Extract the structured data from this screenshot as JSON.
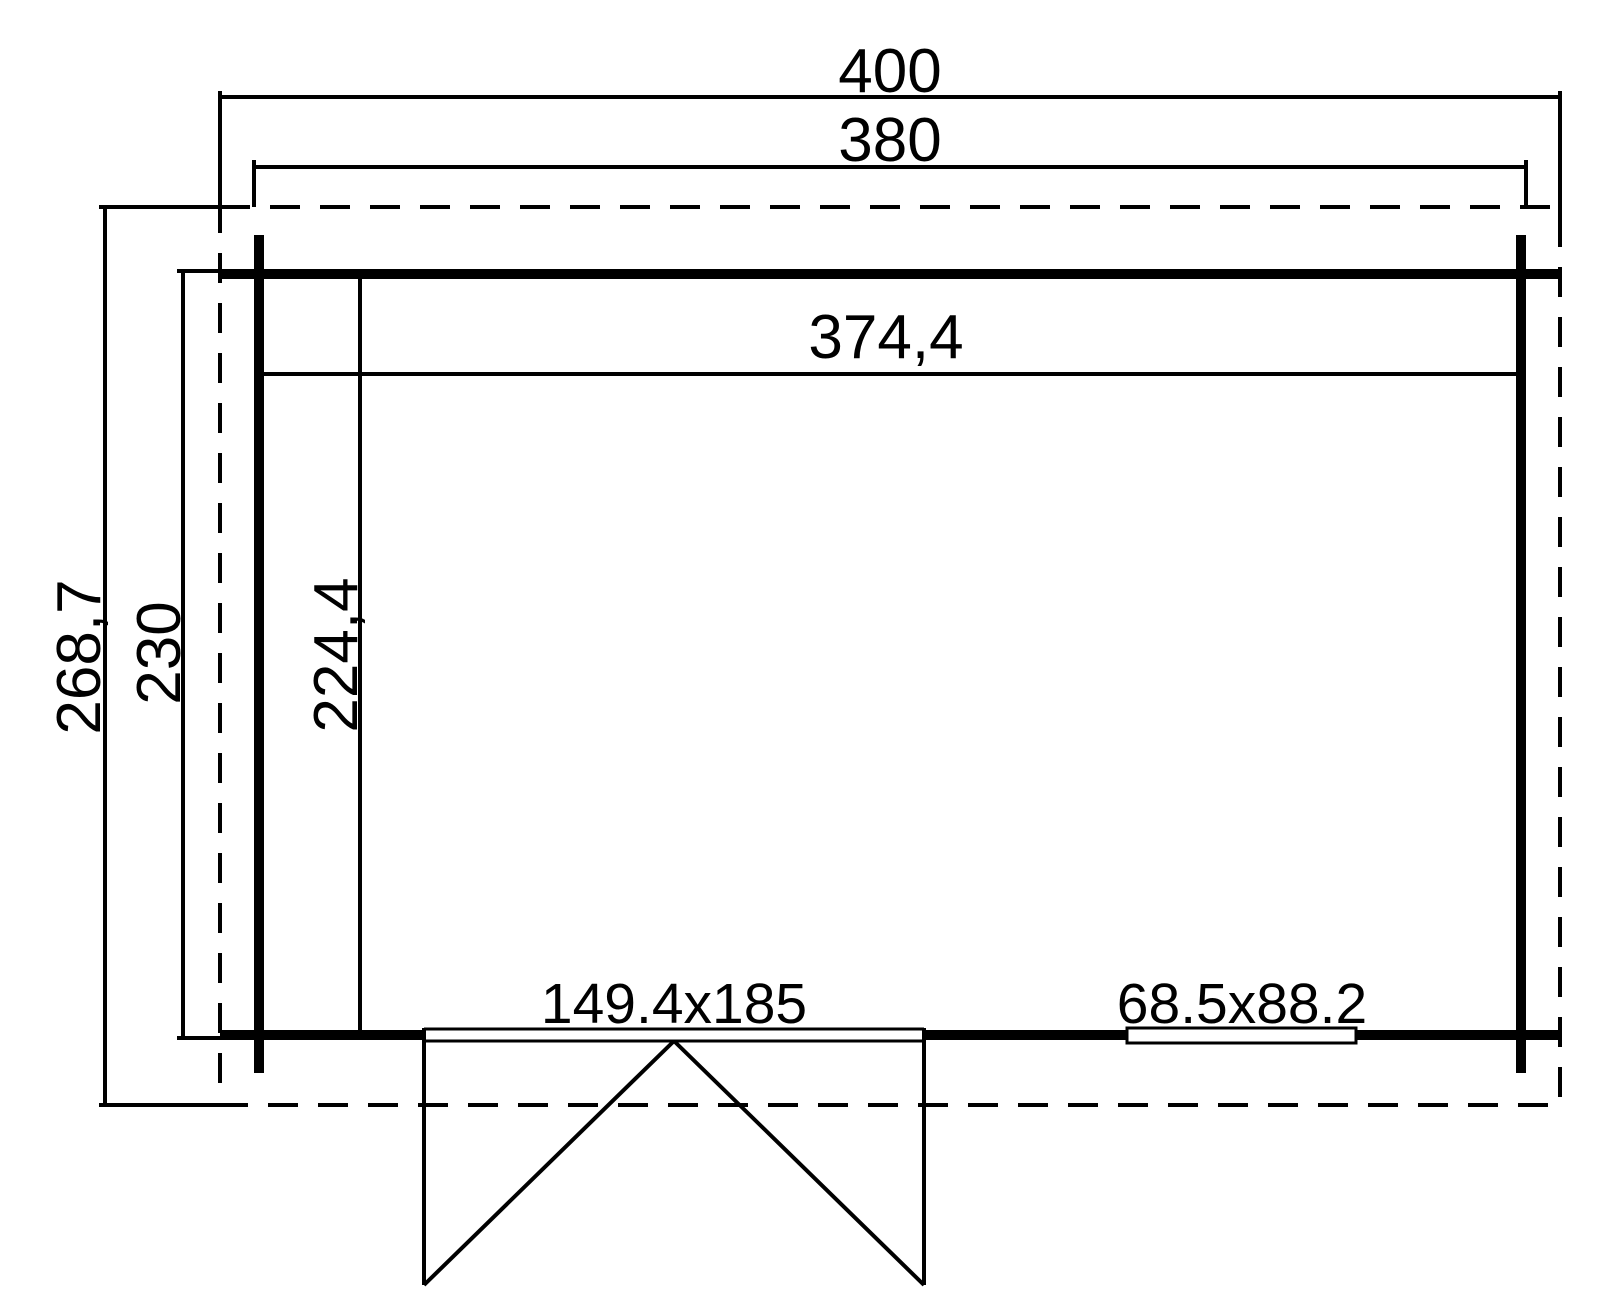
{
  "drawing": {
    "kind": "floor-plan",
    "labels": {
      "roof_width": "400",
      "outer_width": "380",
      "inner_width": "374,4",
      "roof_depth": "268,7",
      "outer_depth": "230",
      "inner_depth": "224,4",
      "door_size": "149.4x185",
      "window_size": "68.5x88.2"
    },
    "colors": {
      "line": "#000000",
      "background": "#ffffff"
    }
  }
}
